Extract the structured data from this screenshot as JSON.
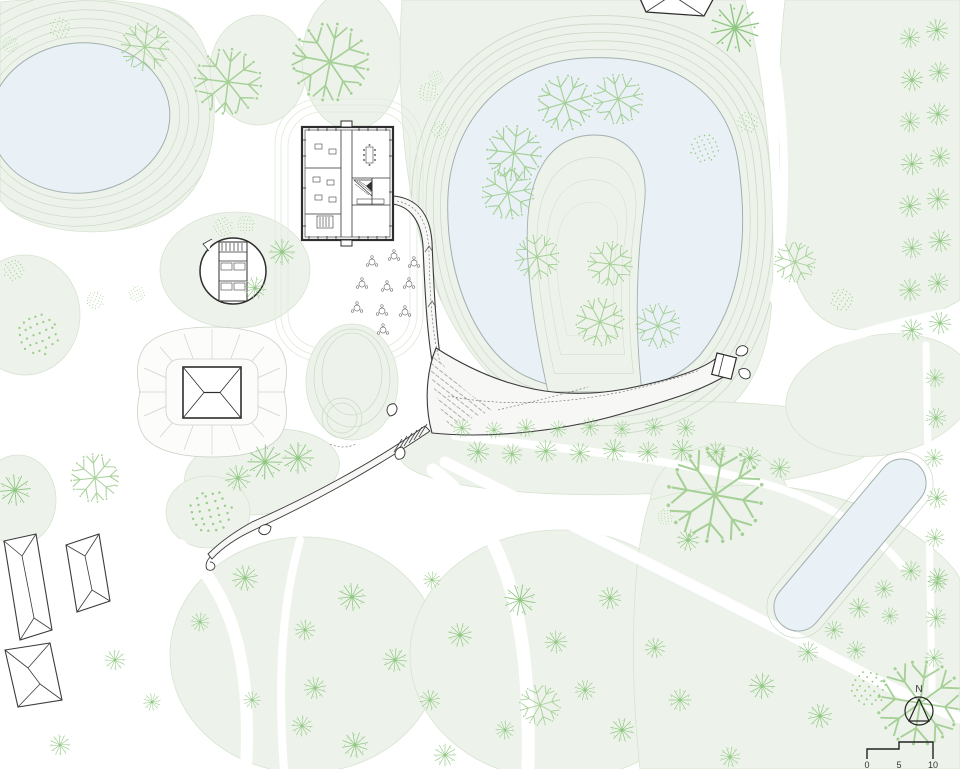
{
  "plan": {
    "compass_label": "N",
    "scale_labels": [
      "0",
      "5",
      "10"
    ]
  },
  "colors": {
    "lawn": "#edf3ea",
    "lawn_stroke": "#d7e3d1",
    "water": "#e9f1f7",
    "water_stroke": "#a2b0ad",
    "contour": "#ccd9c7",
    "path_dark": "#3a3a3a",
    "path_fill": "#f7f8f5",
    "building": "#2e2e2e",
    "tree_star": "#8cc57d",
    "tree_stipple": "#97cb87",
    "tree_branch": "#a3cf93"
  },
  "trees": [
    [
      910,
      38,
      12,
      0
    ],
    [
      937,
      30,
      13,
      0
    ],
    [
      912,
      80,
      13,
      0
    ],
    [
      939,
      72,
      12,
      0
    ],
    [
      910,
      122,
      12,
      0
    ],
    [
      938,
      114,
      13,
      0
    ],
    [
      912,
      164,
      13,
      0
    ],
    [
      940,
      157,
      12,
      0
    ],
    [
      910,
      206,
      13,
      0
    ],
    [
      938,
      199,
      13,
      0
    ],
    [
      912,
      248,
      12,
      0
    ],
    [
      940,
      241,
      13,
      0
    ],
    [
      910,
      290,
      13,
      0
    ],
    [
      938,
      283,
      12,
      0
    ],
    [
      912,
      330,
      13,
      0
    ],
    [
      940,
      323,
      13,
      0
    ],
    [
      935,
      378,
      11,
      0
    ],
    [
      936,
      418,
      12,
      0
    ],
    [
      934,
      458,
      11,
      0
    ],
    [
      937,
      498,
      12,
      0
    ],
    [
      935,
      538,
      11,
      0
    ],
    [
      938,
      578,
      12,
      0
    ],
    [
      936,
      618,
      12,
      0
    ],
    [
      934,
      658,
      11,
      0
    ],
    [
      462,
      428,
      11,
      0
    ],
    [
      494,
      430,
      10,
      0
    ],
    [
      526,
      428,
      11,
      0
    ],
    [
      558,
      429,
      10,
      0
    ],
    [
      590,
      427,
      11,
      0
    ],
    [
      622,
      429,
      10,
      0
    ],
    [
      654,
      427,
      11,
      0
    ],
    [
      686,
      428,
      11,
      0
    ],
    [
      478,
      452,
      13,
      0
    ],
    [
      512,
      454,
      12,
      0
    ],
    [
      546,
      451,
      13,
      0
    ],
    [
      580,
      453,
      12,
      0
    ],
    [
      614,
      450,
      13,
      0
    ],
    [
      648,
      452,
      12,
      0
    ],
    [
      682,
      450,
      13,
      0
    ],
    [
      716,
      452,
      12,
      0
    ],
    [
      750,
      458,
      13,
      0
    ],
    [
      780,
      468,
      12,
      0
    ],
    [
      808,
      652,
      12,
      0
    ],
    [
      834,
      630,
      11,
      0
    ],
    [
      859,
      608,
      12,
      0
    ],
    [
      884,
      589,
      11,
      0
    ],
    [
      911,
      571,
      12,
      0
    ],
    [
      937,
      583,
      11,
      0
    ],
    [
      565,
      103,
      30,
      2
    ],
    [
      618,
      99,
      27,
      2
    ],
    [
      514,
      153,
      30,
      2
    ],
    [
      508,
      193,
      28,
      2
    ],
    [
      537,
      257,
      24,
      2
    ],
    [
      610,
      264,
      24,
      2
    ],
    [
      600,
      322,
      26,
      2
    ],
    [
      658,
      326,
      24,
      2
    ],
    [
      440,
      130,
      11,
      1
    ],
    [
      436,
      78,
      9,
      1
    ],
    [
      705,
      148,
      18,
      1
    ],
    [
      748,
      122,
      13,
      1
    ],
    [
      795,
      262,
      22,
      2
    ],
    [
      842,
      300,
      14,
      1
    ],
    [
      10,
      44,
      10,
      1
    ],
    [
      60,
      28,
      13,
      1
    ],
    [
      145,
      47,
      26,
      2
    ],
    [
      228,
      82,
      36,
      2
    ],
    [
      330,
      62,
      42,
      2
    ],
    [
      428,
      92,
      12,
      1
    ],
    [
      735,
      28,
      28,
      0
    ],
    [
      14,
      270,
      13,
      1
    ],
    [
      38,
      334,
      26,
      1
    ],
    [
      95,
      300,
      11,
      1
    ],
    [
      137,
      294,
      10,
      1
    ],
    [
      223,
      227,
      12,
      1
    ],
    [
      246,
      224,
      11,
      1
    ],
    [
      282,
      252,
      15,
      0
    ],
    [
      255,
      288,
      13,
      0
    ],
    [
      15,
      490,
      18,
      0
    ],
    [
      95,
      478,
      26,
      2
    ],
    [
      210,
      512,
      27,
      1
    ],
    [
      265,
      462,
      20,
      0
    ],
    [
      298,
      458,
      18,
      0
    ],
    [
      238,
      478,
      15,
      0
    ],
    [
      245,
      578,
      15,
      0
    ],
    [
      200,
      622,
      11,
      0
    ],
    [
      305,
      630,
      12,
      0
    ],
    [
      352,
      597,
      16,
      0
    ],
    [
      315,
      688,
      13,
      0
    ],
    [
      355,
      745,
      15,
      0
    ],
    [
      395,
      660,
      14,
      0
    ],
    [
      430,
      700,
      12,
      0
    ],
    [
      460,
      635,
      14,
      0
    ],
    [
      432,
      580,
      10,
      0
    ],
    [
      520,
      600,
      18,
      0
    ],
    [
      556,
      642,
      13,
      0
    ],
    [
      610,
      598,
      13,
      0
    ],
    [
      655,
      648,
      12,
      0
    ],
    [
      585,
      690,
      12,
      0
    ],
    [
      540,
      705,
      22,
      2
    ],
    [
      622,
      730,
      14,
      0
    ],
    [
      680,
      700,
      13,
      0
    ],
    [
      730,
      757,
      12,
      0
    ],
    [
      762,
      686,
      15,
      0
    ],
    [
      820,
      716,
      14,
      0
    ],
    [
      856,
      650,
      11,
      0
    ],
    [
      890,
      616,
      10,
      0
    ],
    [
      302,
      726,
      12,
      0
    ],
    [
      252,
      700,
      10,
      0
    ],
    [
      115,
      660,
      12,
      0
    ],
    [
      152,
      702,
      10,
      0
    ],
    [
      60,
      745,
      12,
      0
    ],
    [
      665,
      517,
      10,
      1
    ],
    [
      688,
      540,
      13,
      0
    ],
    [
      715,
      495,
      52,
      2
    ],
    [
      920,
      703,
      46,
      2
    ],
    [
      868,
      688,
      22,
      1
    ],
    [
      445,
      755,
      13,
      0
    ],
    [
      505,
      730,
      11,
      0
    ]
  ],
  "tables": [
    [
      372,
      262
    ],
    [
      394,
      256
    ],
    [
      414,
      263
    ],
    [
      362,
      284
    ],
    [
      387,
      287
    ],
    [
      409,
      284
    ],
    [
      357,
      308
    ],
    [
      382,
      311
    ],
    [
      405,
      312
    ],
    [
      383,
      330
    ]
  ]
}
